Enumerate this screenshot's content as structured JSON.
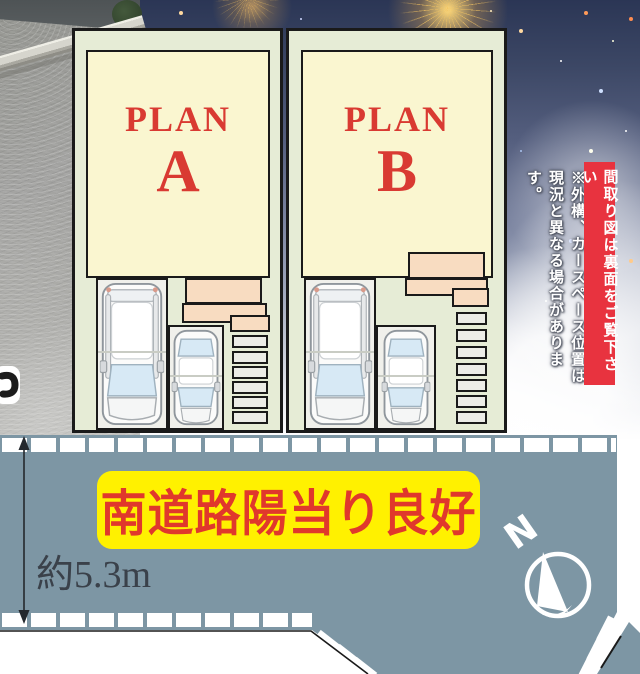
{
  "plots": {
    "plan_a": {
      "word": "PLAN",
      "letter": "A"
    },
    "plan_b": {
      "word": "PLAN",
      "letter": "B"
    }
  },
  "side_notes": {
    "flip_notice": "間取り図は裏面をご覧下さい",
    "disclaimer_line1": "※外構、カースペース位置は",
    "disclaimer_line2": "現況と異なる場合があります。"
  },
  "road": {
    "banner_text": "南道路陽当り良好",
    "width_label": "約5.3m",
    "compass_north": "N"
  },
  "colors": {
    "road_blue_gray": "#7D96A4",
    "plot_cream": "#FAF6D0",
    "plot_pale_green": "#E6ECD6",
    "porch_salmon": "#F8DCC1",
    "banner_yellow": "#FFF100",
    "banner_red_bg": "#E8333F",
    "headline_red": "#E0382C",
    "plan_text_red": "#D93A32"
  }
}
